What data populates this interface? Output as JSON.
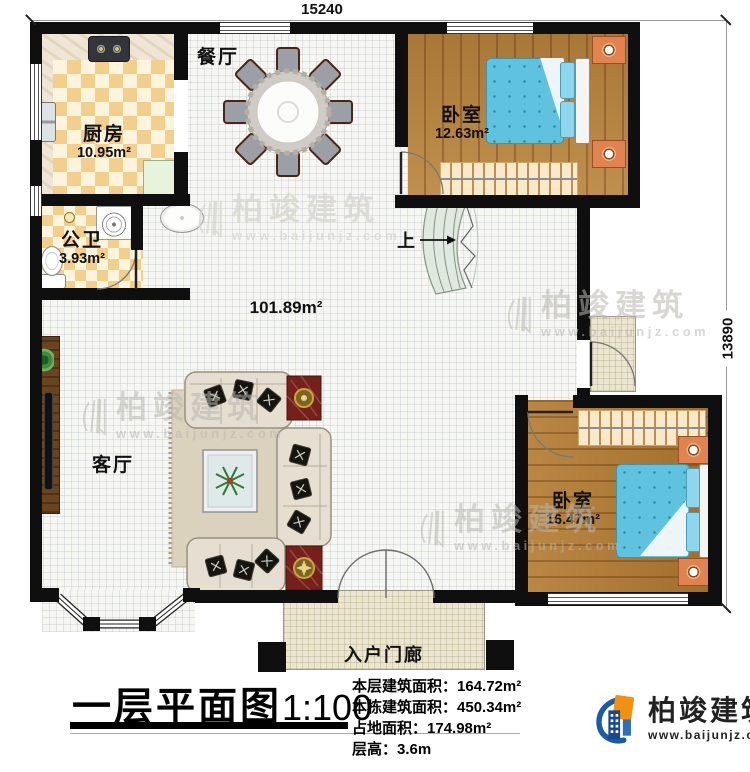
{
  "dimensions": {
    "top": "15240",
    "right": "13890"
  },
  "rooms": {
    "kitchen": {
      "name": "厨房",
      "area": "10.95m²"
    },
    "dining": {
      "name": "餐厅"
    },
    "bedroom1": {
      "name": "卧室",
      "area": "12.63m²"
    },
    "bath": {
      "name": "公卫",
      "area": "3.93m²"
    },
    "living": {
      "name": "客厅"
    },
    "bedroom2": {
      "name": "卧室",
      "area": "16.47m²"
    },
    "porch": {
      "name": "入户门廊"
    },
    "open_area": {
      "area": "101.89m²"
    }
  },
  "stairs": {
    "up_label": "上"
  },
  "title_block": {
    "title": "一层平面图",
    "scale": "1:100",
    "stats": [
      {
        "label": "本层建筑面积：",
        "value": "164.72m²"
      },
      {
        "label": "本栋建筑面积：",
        "value": "450.34m²"
      },
      {
        "label": "占地面积：",
        "value": "174.98m²"
      },
      {
        "label": "层高：",
        "value": "3.6m"
      }
    ]
  },
  "brand": {
    "name": "柏竣建筑",
    "url": "www.baijunjz.com"
  },
  "watermark": {
    "name": "柏竣建筑",
    "url": "www.baijunjz.com"
  },
  "colors": {
    "wall": "#0f0f0f",
    "checker": "#f3cf8e",
    "wood": "#b5823f",
    "bed": "#5fc3e0",
    "brand_blue": "#1b5ba5",
    "brand_orange": "#f29111"
  }
}
